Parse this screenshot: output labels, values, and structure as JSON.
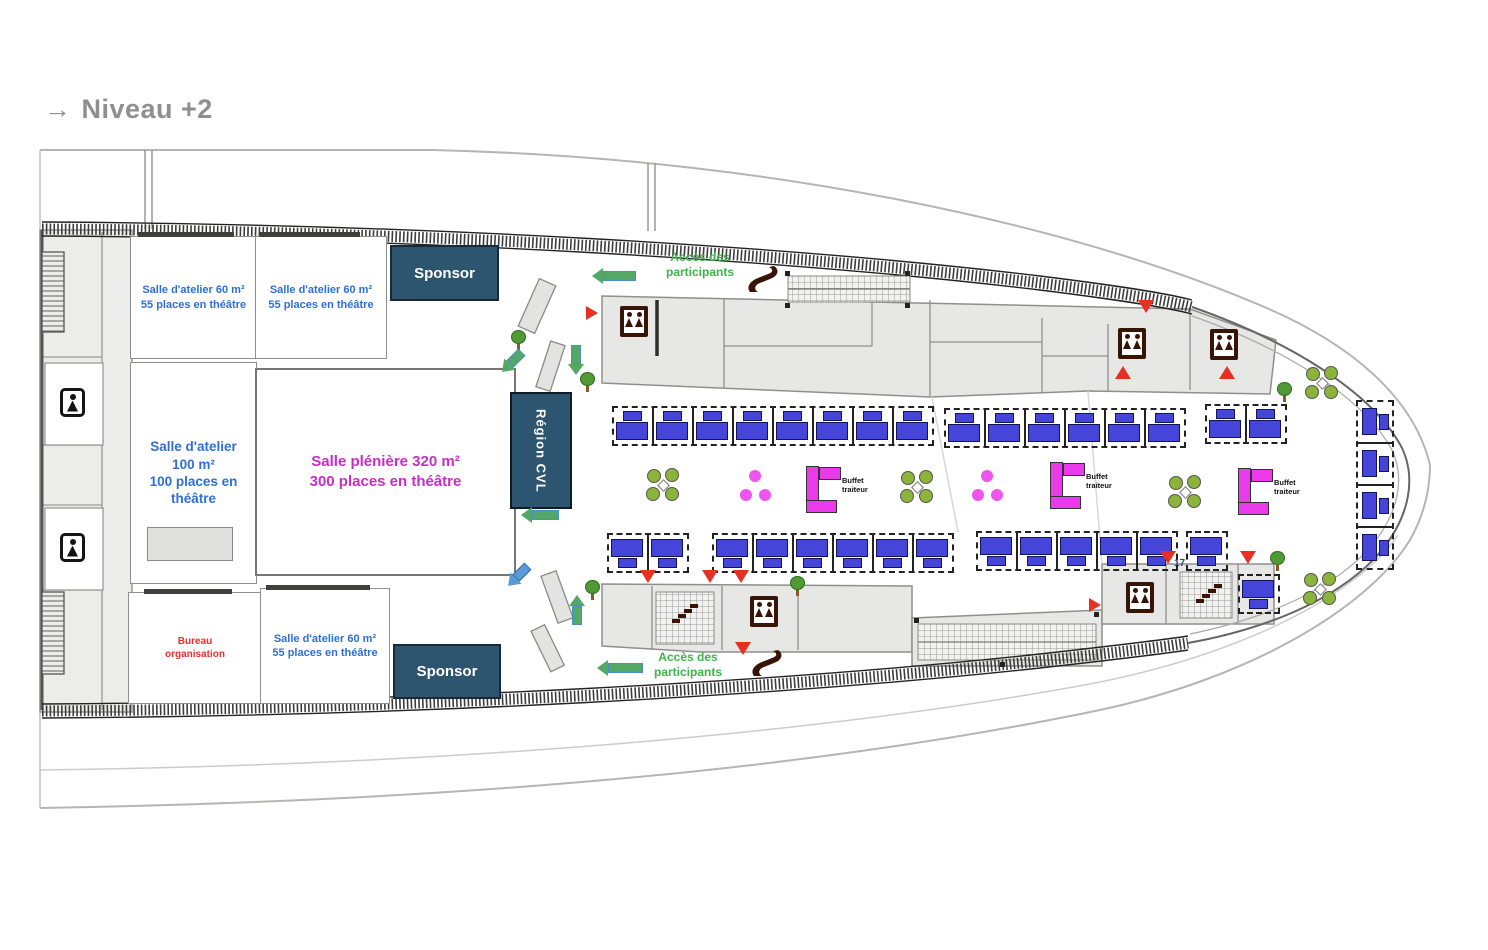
{
  "meta": {
    "title_arrow": "→",
    "title": "Niveau +2"
  },
  "colors": {
    "title-gray": "#8f8f8f",
    "wall-gray": "#8f8f8d",
    "sponsor-bg": "#2e5570",
    "sponsor-border": "#17293a",
    "label-blue": "#2f6fd4",
    "plenary-magenta": "#c62ec6",
    "access-green": "#3cb54a",
    "bureau-red": "#e8322a",
    "booth-blue": "#4545da",
    "booth-border": "#14145a",
    "buffet-magenta": "#ea3aea",
    "icon-brown": "#381407",
    "marker-red": "#e63122",
    "chair-olive": "#8cb43a",
    "tree-green": "#4f9a34",
    "pink-dot": "#ee55ee",
    "arrow-green": "#53a867",
    "arrow-blue": "#5b9bd5",
    "stair-navy": "#27408b"
  },
  "rooms": {
    "workshop_top_left": {
      "line1": "Salle d'atelier 60 m²",
      "line2": "55 places en théâtre"
    },
    "workshop_top_right": {
      "line1": "Salle d'atelier 60 m²",
      "line2": "55 places en théâtre"
    },
    "workshop_100": {
      "line1": "Salle d'atelier",
      "line2": "100 m²",
      "line3": "100 places en",
      "line4": "théâtre"
    },
    "plenary": {
      "line1": "Salle plénière 320 m²",
      "line2": "300 places en théâtre"
    },
    "workshop_bottom": {
      "line1": "Salle d'atelier 60 m²",
      "line2": "55 places en théâtre"
    },
    "bureau": {
      "line1": "Bureau",
      "line2": "organisation"
    },
    "sponsor_top": "Sponsor",
    "sponsor_bottom": "Sponsor",
    "region_cvl": "Région CVL"
  },
  "annotations": {
    "access_top": {
      "line1": "Accès des",
      "line2": "participants"
    },
    "access_bottom": {
      "line1": "Accès des",
      "line2": "participants"
    },
    "buffet_label": {
      "line1": "Buffet",
      "line2": "traiteur"
    },
    "stair_number": "17"
  },
  "furniture": {
    "booth_groups": [
      {
        "x": 612,
        "y": 406,
        "count": 8,
        "dir": "up"
      },
      {
        "x": 944,
        "y": 408,
        "count": 6,
        "dir": "up"
      },
      {
        "x": 1205,
        "y": 404,
        "count": 2,
        "dir": "up"
      },
      {
        "x": 607,
        "y": 533,
        "count": 2,
        "dir": "down"
      },
      {
        "x": 712,
        "y": 533,
        "count": 6,
        "dir": "down"
      },
      {
        "x": 976,
        "y": 531,
        "count": 5,
        "dir": "down"
      },
      {
        "x": 1186,
        "y": 531,
        "count": 1,
        "dir": "down"
      },
      {
        "x": 1238,
        "y": 574,
        "count": 1,
        "dir": "down"
      },
      {
        "x": 1356,
        "y": 400,
        "count": 4,
        "dir": "right"
      }
    ],
    "buffets": [
      {
        "x": 806,
        "y": 466
      },
      {
        "x": 1050,
        "y": 462
      },
      {
        "x": 1238,
        "y": 468
      }
    ],
    "green_tables": [
      {
        "x": 646,
        "y": 468
      },
      {
        "x": 900,
        "y": 470
      },
      {
        "x": 1168,
        "y": 475
      },
      {
        "x": 1305,
        "y": 366
      },
      {
        "x": 1303,
        "y": 572
      }
    ],
    "pink_dot_tables": [
      {
        "x": 740,
        "y": 470
      },
      {
        "x": 972,
        "y": 470
      }
    ],
    "trees": [
      {
        "x": 511,
        "y": 330
      },
      {
        "x": 580,
        "y": 372
      },
      {
        "x": 585,
        "y": 580
      },
      {
        "x": 790,
        "y": 576
      },
      {
        "x": 1277,
        "y": 382
      },
      {
        "x": 1270,
        "y": 551
      }
    ],
    "red_triangles": [
      {
        "x": 586,
        "y": 306,
        "dir": "right"
      },
      {
        "x": 1138,
        "y": 300,
        "dir": "down"
      },
      {
        "x": 1115,
        "y": 366,
        "dir": "up"
      },
      {
        "x": 1219,
        "y": 366,
        "dir": "up"
      },
      {
        "x": 640,
        "y": 570,
        "dir": "down"
      },
      {
        "x": 702,
        "y": 570,
        "dir": "down"
      },
      {
        "x": 733,
        "y": 570,
        "dir": "down"
      },
      {
        "x": 735,
        "y": 642,
        "dir": "down"
      },
      {
        "x": 1160,
        "y": 551,
        "dir": "down"
      },
      {
        "x": 1240,
        "y": 551,
        "dir": "down"
      },
      {
        "x": 1089,
        "y": 598,
        "dir": "right"
      }
    ],
    "arrows": [
      {
        "x": 614,
        "y": 276,
        "dir": "left",
        "len": 44
      },
      {
        "x": 576,
        "y": 360,
        "dir": "down",
        "len": 30
      },
      {
        "x": 512,
        "y": 362,
        "dir": "downleft",
        "len": 28
      },
      {
        "x": 540,
        "y": 515,
        "dir": "left",
        "len": 38
      },
      {
        "x": 518,
        "y": 576,
        "dir": "downleft",
        "len": 28,
        "color": "blue"
      },
      {
        "x": 577,
        "y": 610,
        "dir": "up",
        "len": 30
      },
      {
        "x": 620,
        "y": 668,
        "dir": "left",
        "len": 46
      }
    ],
    "elevators": [
      {
        "x": 620,
        "y": 306
      },
      {
        "x": 1118,
        "y": 328
      },
      {
        "x": 1210,
        "y": 329
      },
      {
        "x": 750,
        "y": 596
      },
      {
        "x": 1126,
        "y": 582
      }
    ],
    "stairs": [
      {
        "x": 672,
        "y": 604
      },
      {
        "x": 1196,
        "y": 584
      }
    ],
    "wc": [
      {
        "x": 60,
        "y": 388
      },
      {
        "x": 60,
        "y": 533
      }
    ]
  }
}
